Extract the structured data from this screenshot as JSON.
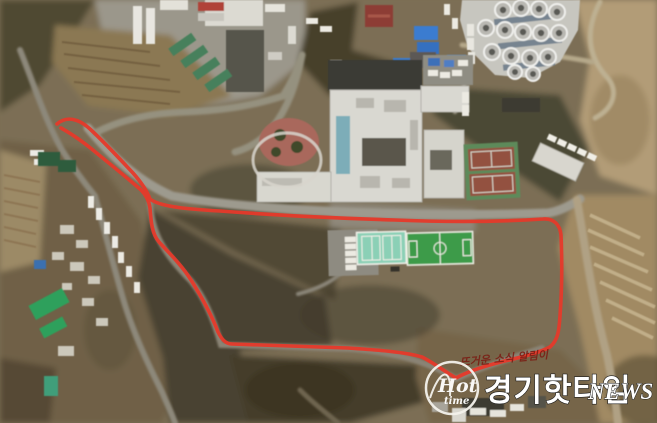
{
  "meta": {
    "type": "aerial-satellite-photo",
    "description": "Aerial view of a school/institution campus with a red walking route drawn around the grounds"
  },
  "watermark": {
    "tagline": "뜨거운 소식 알림이",
    "brand_ko": "경기핫타임",
    "brand_en": "NEWS",
    "logo_line1": "Hot",
    "logo_line2": "time"
  },
  "colors": {
    "route_red": "#e6392a",
    "watermark_white": "#ffffff",
    "tagline_red": "#7a2016",
    "field_green": "#3e9b48",
    "court_mint": "#8bd0b6",
    "tennis_clay": "#935140",
    "tennis_surround": "#5d8a5a",
    "roof_blue": "#3b7cd0",
    "roof_red": "#8d3e36",
    "roof_green": "#2fa05b",
    "building_white": "#d9d8d1"
  },
  "route": {
    "stroke_width": 3.6,
    "path_d": "M 57 124 C 66 116 78 118 90 129 C 103 141 119 158 133 173 C 141 182 147 191 150 199 C 159 206 183 209 220 211 C 272 215 335 218 395 220 C 443 222 497 222 543 219 C 554 218 560 225 561 235 C 562 258 562 290 560 316 C 559 331 558 340 550 347 C 537 354 517 358 497 363 C 482 367 467 372 456 378 C 447 373 434 363 422 357 C 405 352 378 350 348 348 C 316 347 266 345 232 344 C 225 344 221 338 218 332 C 212 316 201 296 191 280 C 181 264 167 251 159 242 C 152 234 151 222 150 208 C 149 201 146 195 141 190 C 131 181 115 168 99 155 C 86 144 72 134 61 128"
  }
}
